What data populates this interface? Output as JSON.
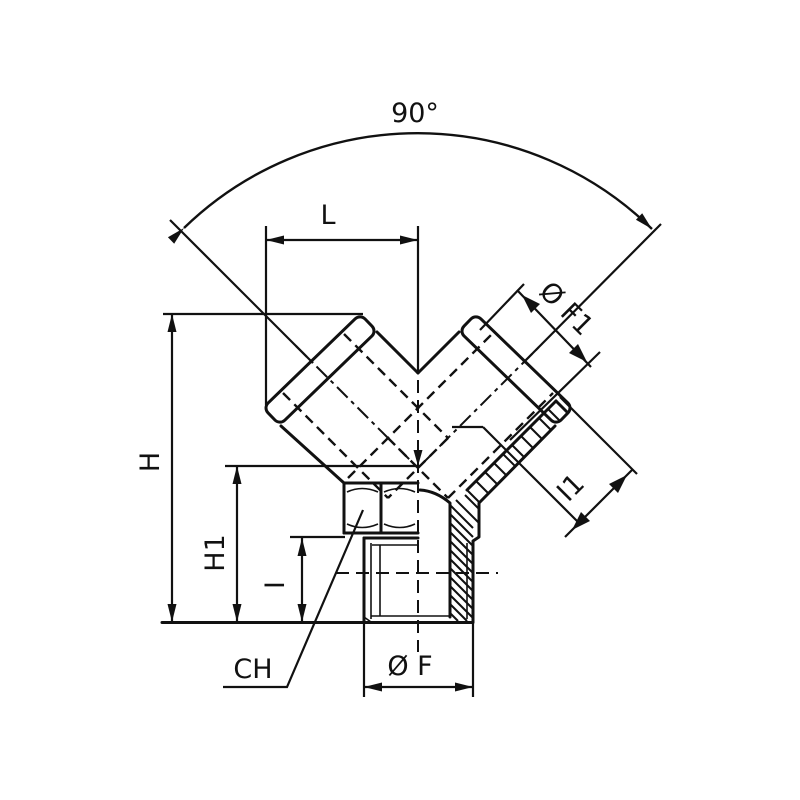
{
  "drawing": {
    "labels": {
      "angle": "90°",
      "length_L": "L",
      "height_H": "H",
      "height_H1": "H1",
      "thread_len_I": "I",
      "arm_thread_len_I1": "I1",
      "bottom_thread_dia": "Ø F",
      "arm_thread_dia": "Ø F1",
      "hex_size": "CH"
    },
    "colors": {
      "line": "#111111",
      "background": "#ffffff"
    }
  }
}
